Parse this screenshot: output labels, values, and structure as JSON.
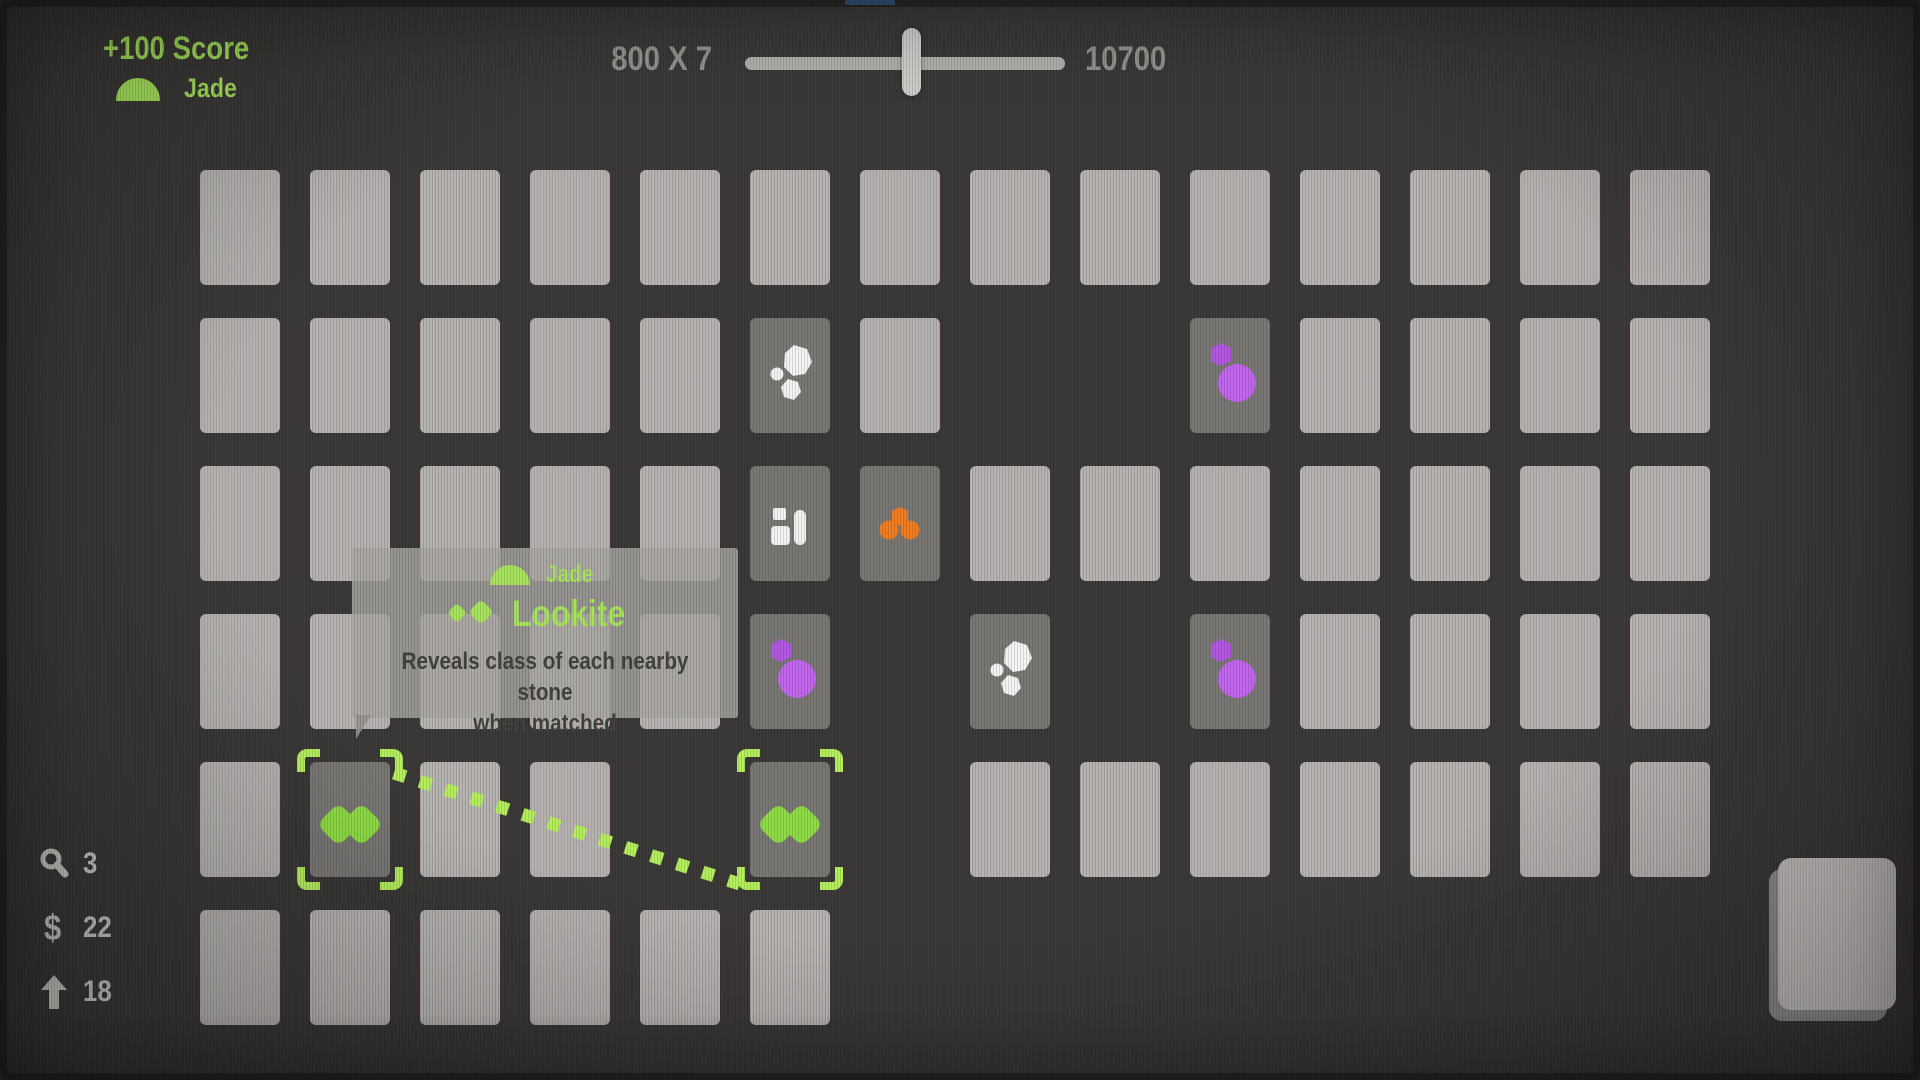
{
  "hud": {
    "score_gain": "+100 Score",
    "matched_stone": "Jade",
    "combo_equation": "800 X 7",
    "combo_total": "10700",
    "slider_fraction": 0.52,
    "counters": [
      {
        "icon": "magnifier-icon",
        "value": "3"
      },
      {
        "icon": "dollar-icon",
        "glyph": "$",
        "value": "22"
      },
      {
        "icon": "upgrade-arrow-icon",
        "value": "18"
      }
    ]
  },
  "tooltip": {
    "stone_class": "Jade",
    "stone_name": "Lookite",
    "description_line1": "Reveals class of each nearby stone",
    "description_line2": "when matched"
  },
  "grid": {
    "cols": 14,
    "rows": 6,
    "cell_legend": {
      "B": "card-face-down",
      "WS": "card-white-stones",
      "SQ": "card-white-squares",
      "OD": "card-orange-dots",
      "PS": "card-purple-stones",
      "JS": "card-jade-selected",
      "": "empty-slot"
    },
    "cells": [
      [
        "B",
        "B",
        "B",
        "B",
        "B",
        "B",
        "B",
        "B",
        "B",
        "B",
        "B",
        "B",
        "B",
        "B"
      ],
      [
        "B",
        "B",
        "B",
        "B",
        "B",
        "WS",
        "B",
        "",
        "",
        "PS",
        "B",
        "B",
        "B",
        "B"
      ],
      [
        "B",
        "B",
        "B",
        "B",
        "B",
        "SQ",
        "OD",
        "B",
        "B",
        "B",
        "B",
        "B",
        "B",
        "B"
      ],
      [
        "B",
        "B",
        "B",
        "B",
        "B",
        "PS",
        "",
        "WS",
        "",
        "PS",
        "B",
        "B",
        "B",
        "B"
      ],
      [
        "B",
        "JS",
        "B",
        "B",
        "",
        "JS",
        "",
        "B",
        "B",
        "B",
        "B",
        "B",
        "B",
        "B"
      ],
      [
        "B",
        "B",
        "B",
        "B",
        "B",
        "B",
        "",
        "",
        "",
        "",
        "",
        "",
        "",
        ""
      ]
    ],
    "selected_link": {
      "from": [
        4,
        1
      ],
      "to": [
        4,
        5
      ]
    }
  },
  "colors": {
    "accent_green": "#a7e35c",
    "jade_gem": "#8fdc46",
    "bracket_green": "#b5ee5d",
    "purple_gem": "#c266ee",
    "purple_gem_dark": "#b258e2",
    "orange_gem": "#f07d22",
    "white_gem": "#f4f3f1",
    "hud_gray": "#94928e",
    "light_gray": "#c9c7c3",
    "tick_blue": "#4d87c7"
  }
}
